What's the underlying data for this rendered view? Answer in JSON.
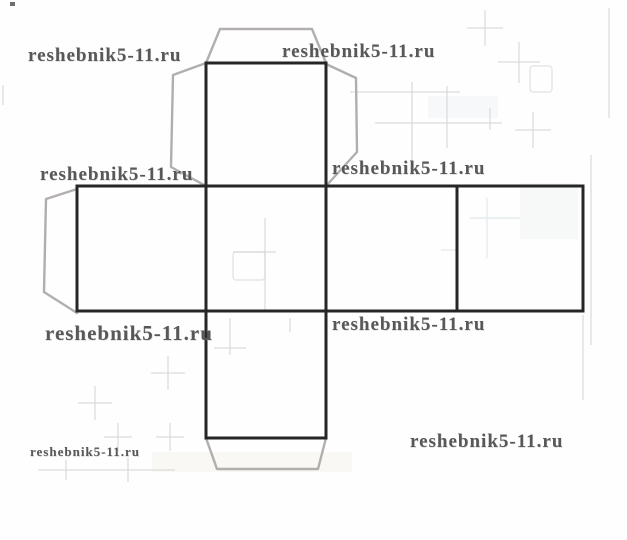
{
  "page": {
    "background": "#fffefe",
    "width": 627,
    "height": 540
  },
  "watermarks": [
    {
      "text": "reshebnik5-11.ru",
      "x": 28,
      "y": 45,
      "font_size": 19
    },
    {
      "text": "reshebnik5-11.ru",
      "x": 282,
      "y": 41,
      "font_size": 19
    },
    {
      "text": "reshebnik5-11.ru",
      "x": 40,
      "y": 164,
      "font_size": 19
    },
    {
      "text": "reshebnik5-11.ru",
      "x": 332,
      "y": 158,
      "font_size": 19
    },
    {
      "text": "reshebnik5-11.ru",
      "x": 45,
      "y": 321,
      "font_size": 21
    },
    {
      "text": "reshebnik5-11.ru",
      "x": 332,
      "y": 314,
      "font_size": 19
    },
    {
      "text": "reshebnik5-11.ru",
      "x": 30,
      "y": 444,
      "font_size": 13
    },
    {
      "text": "reshebnik5-11.ru",
      "x": 410,
      "y": 431,
      "font_size": 19
    }
  ],
  "diagram": {
    "type": "cube-net",
    "outline_color": "#262626",
    "outline_width": 3,
    "flap_color": "#b2aeae",
    "flap_width": 2.4,
    "squares": [
      [
        77,
        186,
        129,
        125
      ],
      [
        206,
        186,
        120,
        125
      ],
      [
        326,
        186,
        131,
        125
      ],
      [
        457,
        186,
        126,
        125
      ],
      [
        206,
        63,
        120,
        123
      ],
      [
        206,
        311,
        120,
        127
      ]
    ],
    "flaps": [
      [
        [
          206,
          63
        ],
        [
          220,
          29
        ],
        [
          312,
          29
        ],
        [
          326,
          63
        ]
      ],
      [
        [
          206,
          63
        ],
        [
          173,
          75
        ],
        [
          171,
          167
        ],
        [
          206,
          186
        ]
      ],
      [
        [
          326,
          64
        ],
        [
          356,
          78
        ],
        [
          357,
          152
        ],
        [
          326,
          186
        ]
      ],
      [
        [
          77,
          189
        ],
        [
          46,
          199
        ],
        [
          44,
          292
        ],
        [
          77,
          313
        ]
      ],
      [
        [
          206,
          438
        ],
        [
          217,
          469
        ],
        [
          318,
          469
        ],
        [
          326,
          438
        ]
      ]
    ]
  },
  "artifacts": {
    "line_color": "#d7d7d7",
    "blue_line_color": "#e2eaee",
    "mark_color": "#6e6e6e",
    "lines": [
      [
        467,
        28,
        503,
        28
      ],
      [
        485,
        10,
        485,
        46
      ],
      [
        498,
        62,
        540,
        62
      ],
      [
        519,
        42,
        519,
        83
      ],
      [
        515,
        130,
        551,
        130
      ],
      [
        533,
        112,
        533,
        148
      ],
      [
        350,
        92,
        460,
        92
      ],
      [
        375,
        123,
        502,
        123
      ],
      [
        412,
        82,
        412,
        170
      ],
      [
        447,
        86,
        447,
        148
      ],
      [
        490,
        108,
        490,
        130
      ],
      [
        265,
        218,
        265,
        312
      ],
      [
        233,
        252,
        276,
        252
      ],
      [
        214,
        348,
        246,
        348
      ],
      [
        230,
        318,
        230,
        355
      ],
      [
        290,
        318,
        290,
        332
      ],
      [
        151,
        373,
        185,
        373
      ],
      [
        168,
        356,
        168,
        390
      ],
      [
        78,
        403,
        112,
        403
      ],
      [
        95,
        386,
        95,
        420
      ],
      [
        104,
        437,
        132,
        437
      ],
      [
        118,
        423,
        118,
        451
      ],
      [
        156,
        437,
        184,
        437
      ],
      [
        170,
        423,
        170,
        451
      ],
      [
        38,
        470,
        175,
        470
      ],
      [
        66,
        460,
        66,
        480
      ],
      [
        128,
        458,
        128,
        482
      ],
      [
        591,
        155,
        591,
        345
      ],
      [
        609,
        8,
        609,
        118
      ],
      [
        583,
        315,
        583,
        400
      ],
      [
        3,
        85,
        3,
        105
      ]
    ],
    "blue_lines": [
      [
        487,
        198,
        487,
        258
      ],
      [
        470,
        218,
        520,
        218
      ],
      [
        441,
        250,
        456,
        250
      ]
    ],
    "outline_rects": [
      [
        530,
        66,
        22,
        26
      ],
      [
        233,
        252,
        32,
        28
      ]
    ],
    "tints": [
      [
        428,
        96,
        70,
        22,
        "#edf2f3"
      ],
      [
        520,
        183,
        58,
        56,
        "#eef3f2"
      ],
      [
        152,
        452,
        200,
        20,
        "#f6f2ea"
      ]
    ],
    "marks": [
      [
        10,
        2,
        5,
        4
      ]
    ]
  }
}
